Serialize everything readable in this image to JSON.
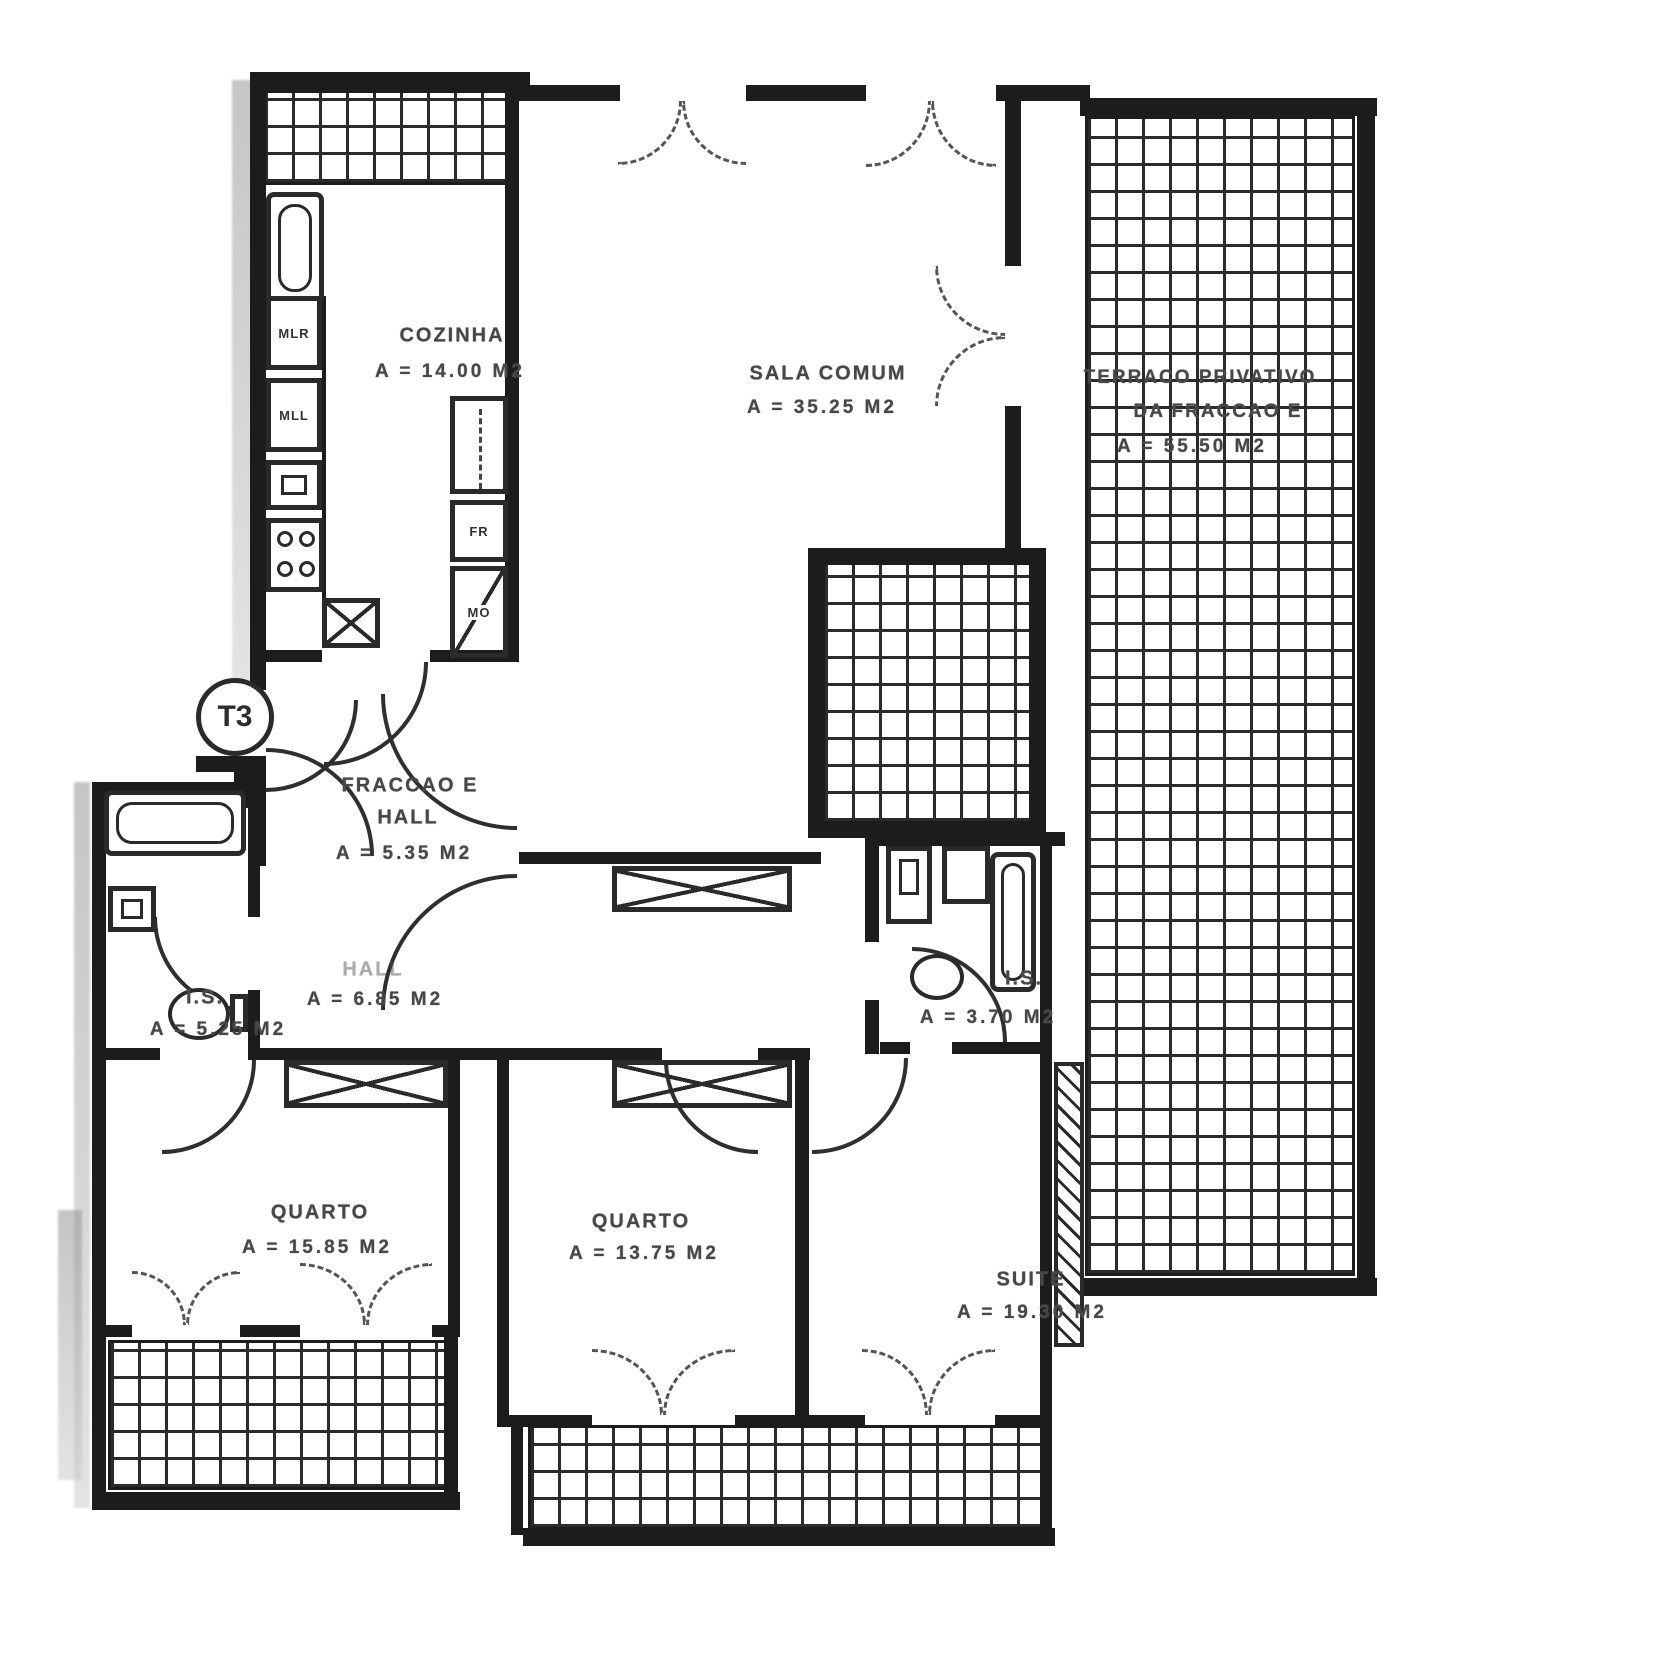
{
  "plan": {
    "badge": "T3",
    "rooms": {
      "cozinha": {
        "name": "COZINHA",
        "area": "A = 14.00 M2"
      },
      "sala": {
        "name": "SALA COMUM",
        "area": "A = 35.25 M2"
      },
      "terraco": {
        "line1": "TERRACO PRIVATIVO",
        "line2": "DA FRACCAO E",
        "area": "A = 55.50 M2"
      },
      "hall_entrada": {
        "line1": "FRACCAO E",
        "line2": "HALL",
        "area": "A = 5.35 M2"
      },
      "hall2": {
        "name": "HALL",
        "area": "A = 6.85 M2"
      },
      "is_left": {
        "name": "I.S.",
        "area": "A = 5.25 M2"
      },
      "is_right": {
        "name": "I.S.",
        "area": "A = 3.70 M2"
      },
      "quarto1": {
        "name": "QUARTO",
        "area": "A = 15.85 M2"
      },
      "quarto2": {
        "name": "QUARTO",
        "area": "A = 13.75 M2"
      },
      "suite": {
        "name": "SUITE",
        "area": "A = 19.30 M2"
      }
    },
    "appliances": {
      "mlr": "MLR",
      "mll": "MLL",
      "fr": "FR",
      "mo": "MO"
    }
  }
}
